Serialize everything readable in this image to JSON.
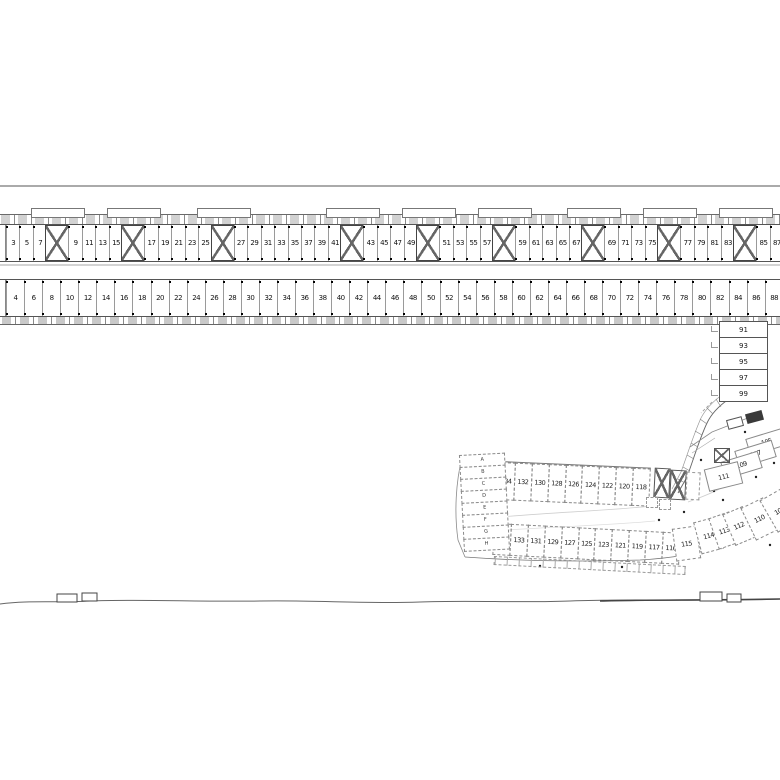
{
  "drawing": {
    "kind": "site-floor-plan",
    "colors": {
      "line": "#555555",
      "line_light": "#999999",
      "text": "#111111",
      "bg": "#ffffff"
    }
  },
  "upper_row": {
    "cells": [
      {
        "k": "u",
        "n": "3"
      },
      {
        "k": "u",
        "n": "5"
      },
      {
        "k": "u",
        "n": "7"
      },
      {
        "k": "s",
        "n": ""
      },
      {
        "k": "u",
        "n": "9"
      },
      {
        "k": "u",
        "n": "11"
      },
      {
        "k": "u",
        "n": "13"
      },
      {
        "k": "u",
        "n": "15"
      },
      {
        "k": "s",
        "n": ""
      },
      {
        "k": "u",
        "n": "17"
      },
      {
        "k": "u",
        "n": "19"
      },
      {
        "k": "u",
        "n": "21"
      },
      {
        "k": "u",
        "n": "23"
      },
      {
        "k": "u",
        "n": "25"
      },
      {
        "k": "s",
        "n": ""
      },
      {
        "k": "u",
        "n": "27"
      },
      {
        "k": "u",
        "n": "29"
      },
      {
        "k": "u",
        "n": "31"
      },
      {
        "k": "u",
        "n": "33"
      },
      {
        "k": "u",
        "n": "35"
      },
      {
        "k": "u",
        "n": "37"
      },
      {
        "k": "u",
        "n": "39"
      },
      {
        "k": "u",
        "n": "41"
      },
      {
        "k": "s",
        "n": ""
      },
      {
        "k": "u",
        "n": "43"
      },
      {
        "k": "u",
        "n": "45"
      },
      {
        "k": "u",
        "n": "47"
      },
      {
        "k": "u",
        "n": "49"
      },
      {
        "k": "s",
        "n": ""
      },
      {
        "k": "u",
        "n": "51"
      },
      {
        "k": "u",
        "n": "53"
      },
      {
        "k": "u",
        "n": "55"
      },
      {
        "k": "u",
        "n": "57"
      },
      {
        "k": "s",
        "n": ""
      },
      {
        "k": "u",
        "n": "59"
      },
      {
        "k": "u",
        "n": "61"
      },
      {
        "k": "u",
        "n": "63"
      },
      {
        "k": "u",
        "n": "65"
      },
      {
        "k": "u",
        "n": "67"
      },
      {
        "k": "s",
        "n": ""
      },
      {
        "k": "u",
        "n": "69"
      },
      {
        "k": "u",
        "n": "71"
      },
      {
        "k": "u",
        "n": "73"
      },
      {
        "k": "u",
        "n": "75"
      },
      {
        "k": "s",
        "n": ""
      },
      {
        "k": "u",
        "n": "77"
      },
      {
        "k": "u",
        "n": "79"
      },
      {
        "k": "u",
        "n": "81"
      },
      {
        "k": "u",
        "n": "83"
      },
      {
        "k": "s",
        "n": ""
      },
      {
        "k": "u",
        "n": "85"
      },
      {
        "k": "u",
        "n": "87"
      }
    ]
  },
  "lower_row": {
    "cells": [
      {
        "k": "u",
        "n": "4"
      },
      {
        "k": "u",
        "n": "6"
      },
      {
        "k": "u",
        "n": "8"
      },
      {
        "k": "u",
        "n": "10"
      },
      {
        "k": "u",
        "n": "12"
      },
      {
        "k": "u",
        "n": "14"
      },
      {
        "k": "u",
        "n": "16"
      },
      {
        "k": "u",
        "n": "18"
      },
      {
        "k": "u",
        "n": "20"
      },
      {
        "k": "u",
        "n": "22"
      },
      {
        "k": "u",
        "n": "24"
      },
      {
        "k": "u",
        "n": "26"
      },
      {
        "k": "u",
        "n": "28"
      },
      {
        "k": "u",
        "n": "30"
      },
      {
        "k": "u",
        "n": "32"
      },
      {
        "k": "u",
        "n": "34"
      },
      {
        "k": "u",
        "n": "36"
      },
      {
        "k": "u",
        "n": "38"
      },
      {
        "k": "u",
        "n": "40"
      },
      {
        "k": "u",
        "n": "42"
      },
      {
        "k": "u",
        "n": "44"
      },
      {
        "k": "u",
        "n": "46"
      },
      {
        "k": "u",
        "n": "48"
      },
      {
        "k": "u",
        "n": "50"
      },
      {
        "k": "u",
        "n": "52"
      },
      {
        "k": "u",
        "n": "54"
      },
      {
        "k": "u",
        "n": "56"
      },
      {
        "k": "u",
        "n": "58"
      },
      {
        "k": "u",
        "n": "60"
      },
      {
        "k": "u",
        "n": "62"
      },
      {
        "k": "u",
        "n": "64"
      },
      {
        "k": "u",
        "n": "66"
      },
      {
        "k": "u",
        "n": "68"
      },
      {
        "k": "u",
        "n": "70"
      },
      {
        "k": "u",
        "n": "72"
      },
      {
        "k": "u",
        "n": "74"
      },
      {
        "k": "u",
        "n": "76"
      },
      {
        "k": "u",
        "n": "78"
      },
      {
        "k": "u",
        "n": "80"
      },
      {
        "k": "u",
        "n": "82"
      },
      {
        "k": "u",
        "n": "84"
      },
      {
        "k": "u",
        "n": "86"
      },
      {
        "k": "u",
        "n": "88"
      }
    ]
  },
  "stack": {
    "units": [
      "91",
      "93",
      "95",
      "97",
      "99"
    ]
  },
  "cluster": {
    "units": [
      "105",
      "107",
      "109",
      "111"
    ]
  },
  "terrace_upper": {
    "units": [
      "134",
      "132",
      "130",
      "128",
      "126",
      "124",
      "122",
      "120",
      "118"
    ]
  },
  "terrace_lower": {
    "units": [
      "135",
      "133",
      "131",
      "129",
      "127",
      "125",
      "123",
      "121",
      "119",
      "117",
      "116"
    ]
  },
  "terrace_curve": {
    "units": [
      "115",
      "114",
      "113",
      "112",
      "110",
      "108"
    ]
  },
  "bays": {
    "letters": [
      "A",
      "B",
      "C",
      "D",
      "E",
      "F",
      "G",
      "H"
    ]
  }
}
